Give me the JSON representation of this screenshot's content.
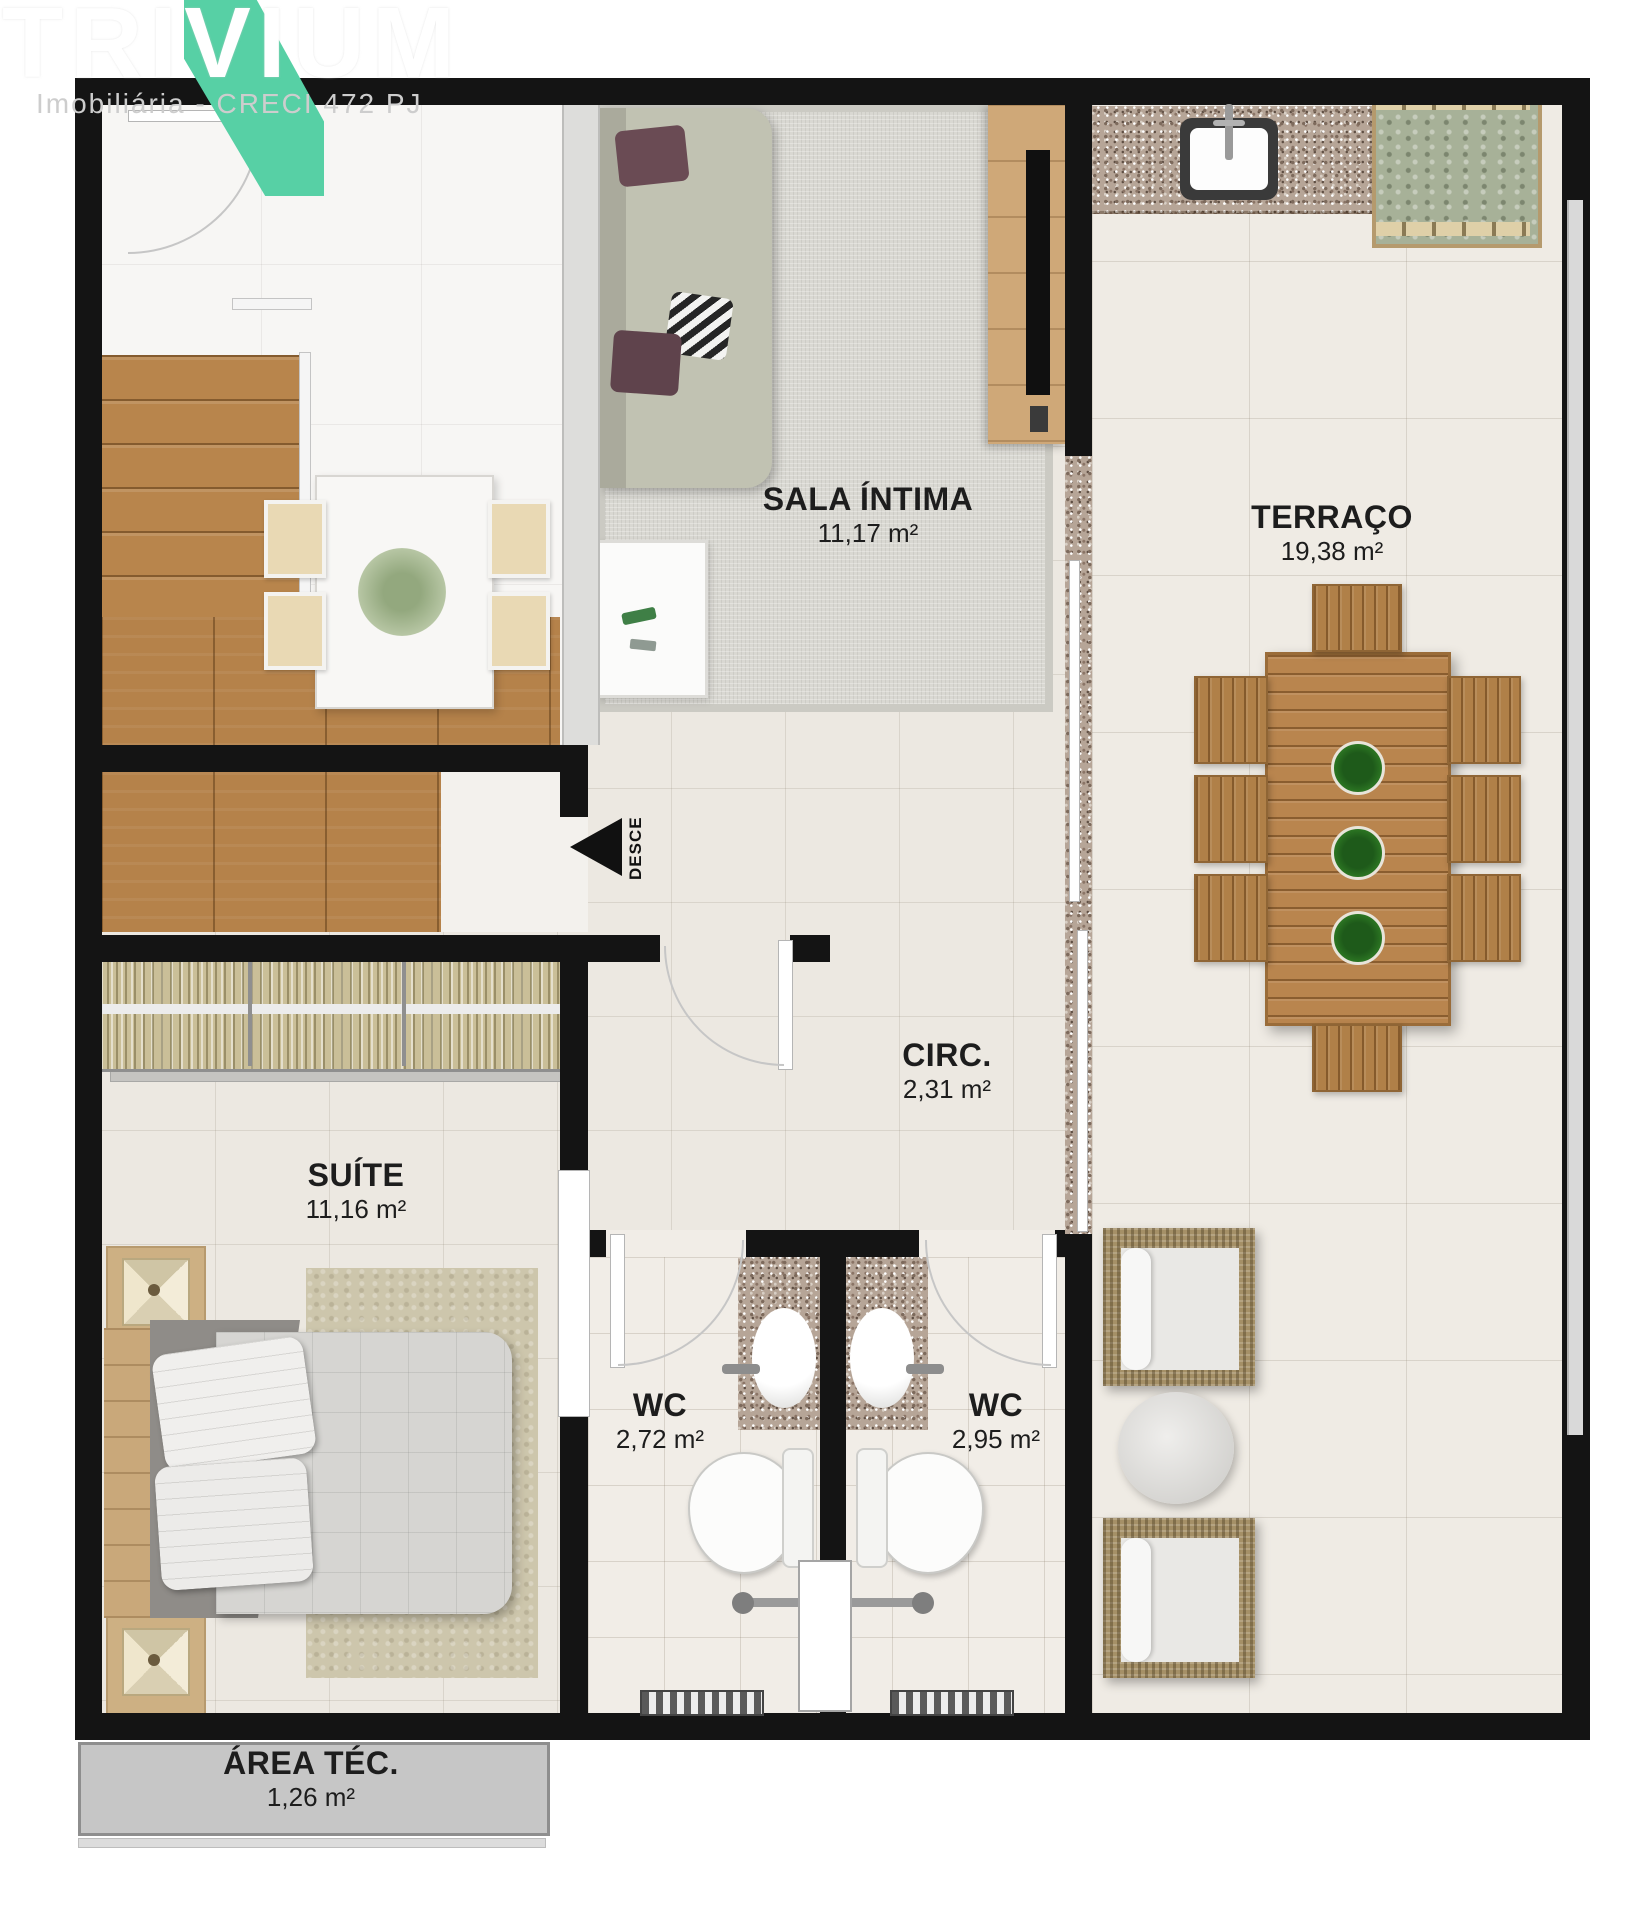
{
  "logo": {
    "brand": "TRIVIUM",
    "subtitle": "Imobiliária - CRECI 472 PJ"
  },
  "rooms": {
    "sala_intima": {
      "name": "SALA ÍNTIMA",
      "area": "11,17 m²"
    },
    "terraco": {
      "name": "TERRAÇO",
      "area": "19,38 m²"
    },
    "circ": {
      "name": "CIRC.",
      "area": "2,31 m²"
    },
    "suite": {
      "name": "SUÍTE",
      "area": "11,16 m²"
    },
    "wc_left": {
      "name": "WC",
      "area": "2,72 m²"
    },
    "wc_right": {
      "name": "WC",
      "area": "2,95 m²"
    },
    "area_tec": {
      "name": "ÁREA TÉC.",
      "area": "1,26 m²"
    }
  },
  "stairs": {
    "direction_label": "DESCE"
  },
  "colors": {
    "brand_green": "#57d0a5",
    "wall": "#141414",
    "floor_tile": "#ece8e1",
    "wood": "#b8854c",
    "granite": "#b6a597"
  }
}
